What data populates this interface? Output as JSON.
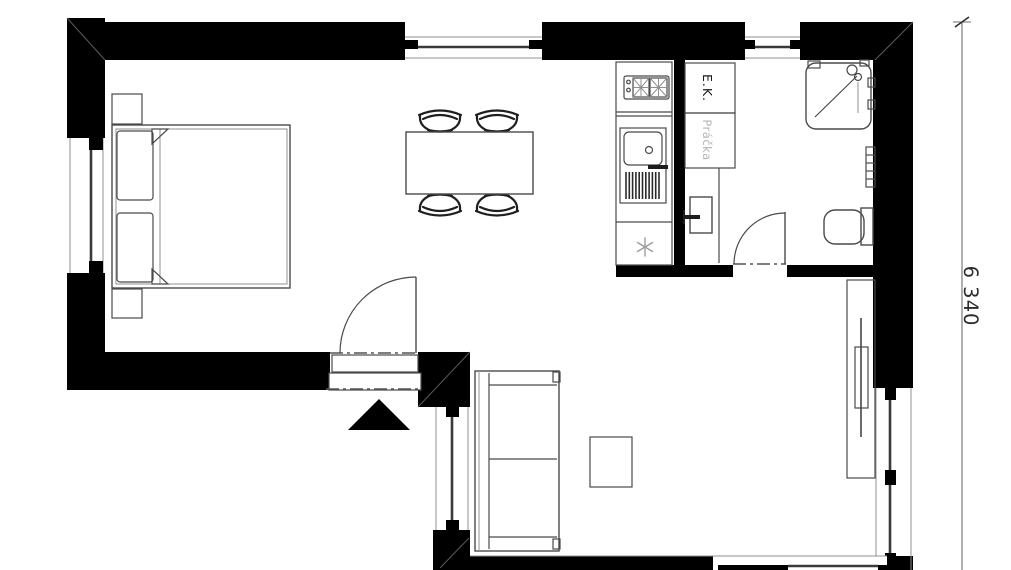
{
  "document": {
    "type": "architectural-floor-plan"
  },
  "labels": {
    "kitchen_unit": "E.K.",
    "washing_machine": "Práčka"
  },
  "dimension": {
    "height_label": "6 340"
  },
  "colors": {
    "walls": "#000000",
    "furniture_lines": "#4a4a4a",
    "muted_label": "#b5b5b5",
    "dimension_text": "#2b2b2b",
    "background": "#ffffff"
  },
  "symbols": [
    "bed",
    "pillow",
    "nightstand",
    "dining-table",
    "chair",
    "kitchen-counter",
    "cooktop",
    "sink",
    "dish-drainer",
    "fridge-asterisk",
    "water-heater",
    "shower",
    "towel-radiator",
    "toilet",
    "sofa",
    "coffee-table",
    "tv-cabinet",
    "tv",
    "door-swing",
    "entrance-arrow",
    "window",
    "dimension-line"
  ]
}
